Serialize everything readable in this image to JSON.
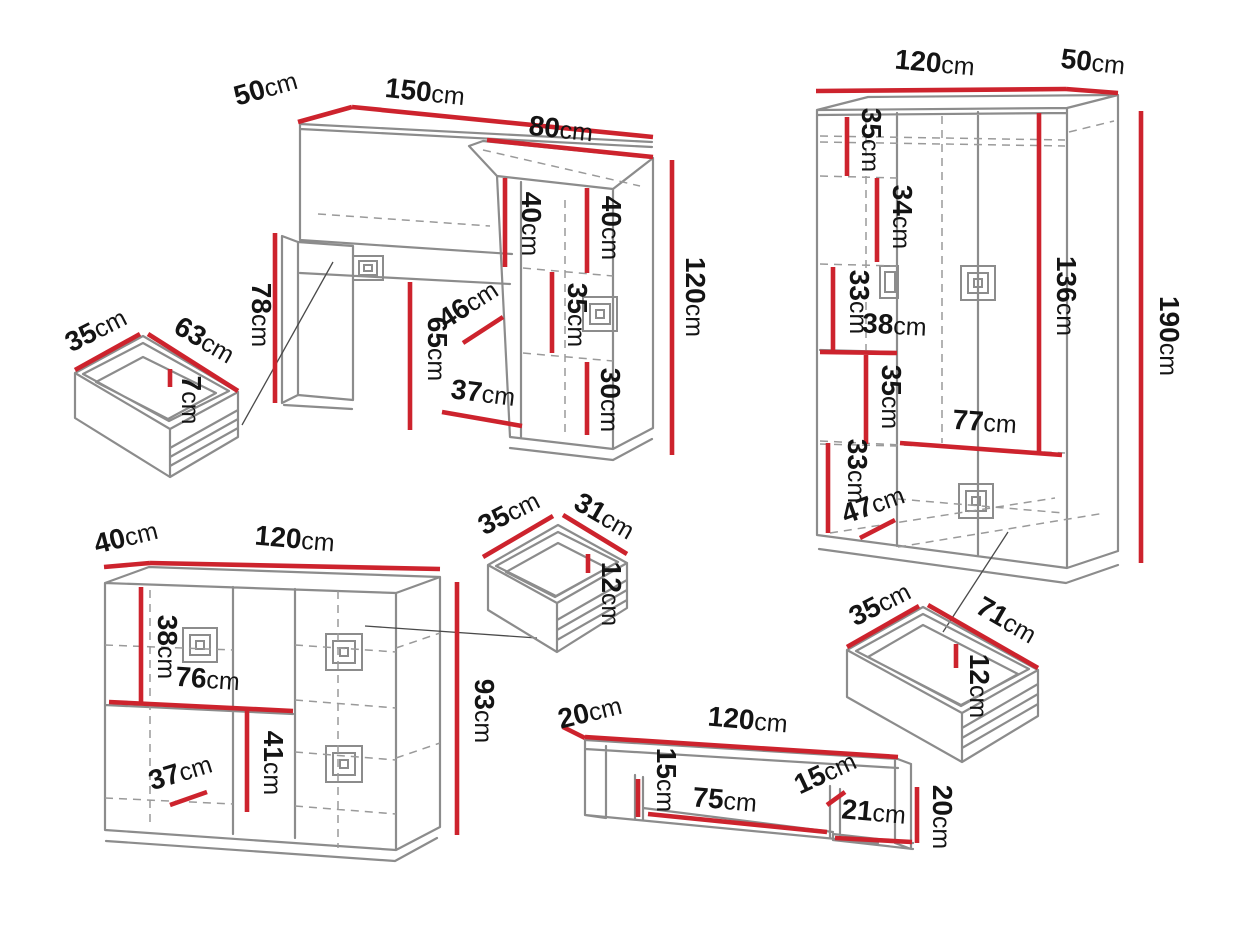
{
  "unit": "cm",
  "title": "furniture-dimensions-diagram",
  "colors": {
    "dimension_line": "#cd232d",
    "drawing_line": "#8c8c8c",
    "label_text": "#141414"
  },
  "pieces": {
    "dressing_table": {
      "depth": "50",
      "width": "150",
      "hutch_width": "80",
      "hutch_left_height": "40",
      "hutch_right_height": "40",
      "total_height": "120",
      "desk_height": "78",
      "knee_height": "65",
      "handle_diag": "46",
      "shelf_upper": "35",
      "shelf_lower": "30",
      "door_width": "37"
    },
    "drawer_small": {
      "width": "35",
      "length": "63",
      "height": "7"
    },
    "wardrobe": {
      "width": "120",
      "depth": "50",
      "height": "190",
      "inner_height": "136",
      "inner_width": "77",
      "shelf_1": "35",
      "shelf_2": "34",
      "shelf_3": "33",
      "shelf_width": "38",
      "shelf_4": "35",
      "shelf_5": "33",
      "drawer_diag": "47"
    },
    "chest": {
      "depth": "40",
      "width": "120",
      "height": "93",
      "shelf_height": "38",
      "shelf_width": "76",
      "lower_height": "41",
      "door_width": "37"
    },
    "drawer_mid": {
      "width": "35",
      "length": "31",
      "height": "12"
    },
    "drawer_wide": {
      "width": "35",
      "length": "71",
      "height": "12"
    },
    "wall_shelf": {
      "depth": "20",
      "width": "120",
      "end_height": "15",
      "opening": "75",
      "inner_height": "15",
      "ledge": "21",
      "right_height": "20"
    }
  }
}
